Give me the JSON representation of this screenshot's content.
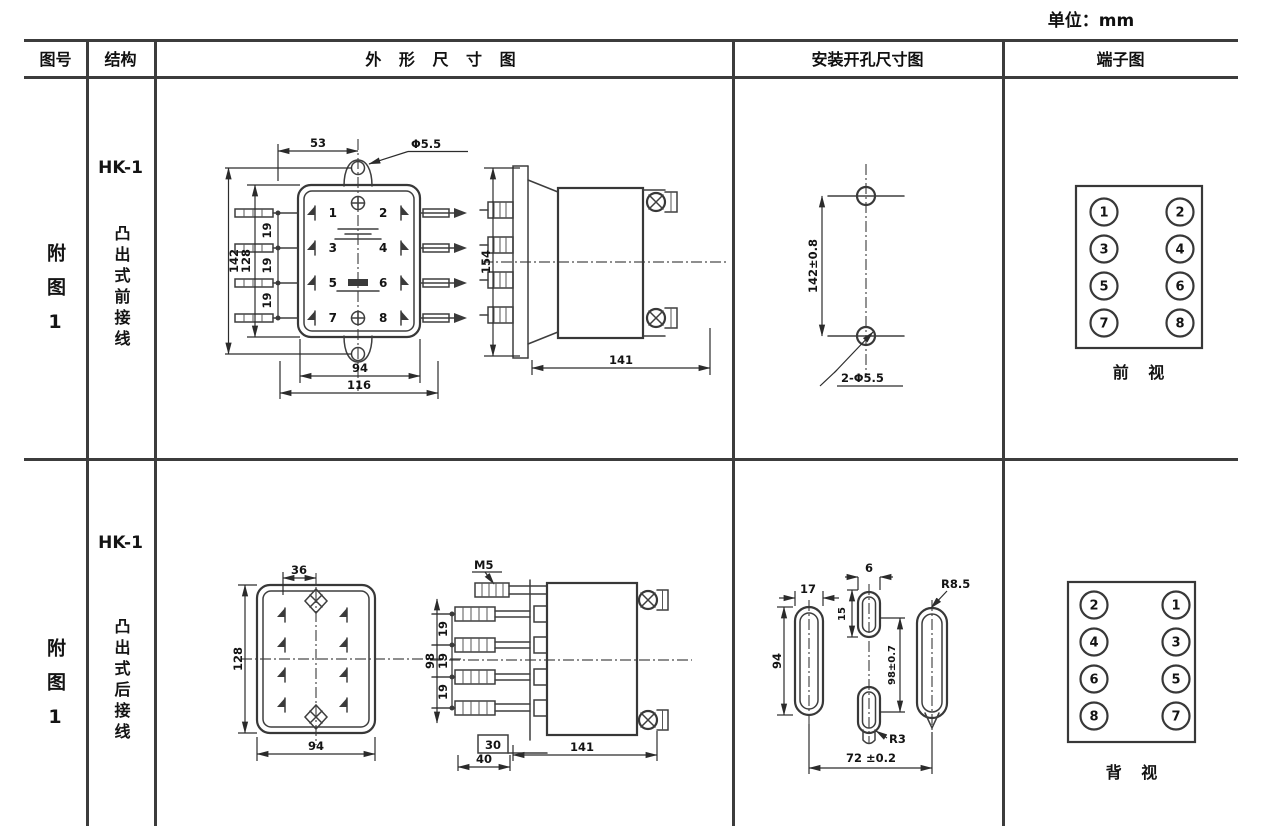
{
  "unit_label": "单位：mm",
  "table_headers": {
    "figure_no": "图号",
    "structure": "结构",
    "outline": "外 形 尺 寸 图",
    "install": "安装开孔尺寸图",
    "terminal": "端子图"
  },
  "row1": {
    "figure_no": "附图1",
    "model": "HK-1",
    "structure_type": "凸出式前接线",
    "front_view": {
      "dim_top": "53",
      "hole": "Φ5.5",
      "dim_h_outer": "142",
      "dim_h_inner": "128",
      "pitch": [
        "19",
        "19",
        "19"
      ],
      "terminals": [
        "1",
        "2",
        "3",
        "4",
        "5",
        "6",
        "7",
        "8"
      ],
      "dim_w_inner": "94",
      "dim_w_outer": "116"
    },
    "side_view": {
      "dim_h": "154",
      "dim_d": "141"
    },
    "install_view": {
      "dim_v": "142±0.8",
      "holes": "2-Φ5.5"
    },
    "terminal_view": {
      "numbers": [
        "1",
        "2",
        "3",
        "4",
        "5",
        "6",
        "7",
        "8"
      ],
      "caption": "前 视"
    }
  },
  "row2": {
    "figure_no": "附图1",
    "model": "HK-1",
    "structure_type": "凸出式后接线",
    "rear_view": {
      "dim_top": "36",
      "dim_h": "128",
      "dim_w": "94"
    },
    "side_view": {
      "screw": "M5",
      "dim_h": "98",
      "pitch": [
        "19",
        "19",
        "19"
      ],
      "dim_30": "30",
      "dim_40": "40",
      "dim_d": "141"
    },
    "install_view": {
      "slot_w": "17",
      "slot_h": "94",
      "mid_w": "6",
      "mid_h": "15",
      "dim_v": "98±0.7",
      "r_bottom": "R3",
      "r_side": "R8.5",
      "dim_span": "72 ±0.2"
    },
    "terminal_view": {
      "numbers": [
        "2",
        "1",
        "4",
        "3",
        "6",
        "5",
        "8",
        "7"
      ],
      "caption": "背 视"
    }
  }
}
